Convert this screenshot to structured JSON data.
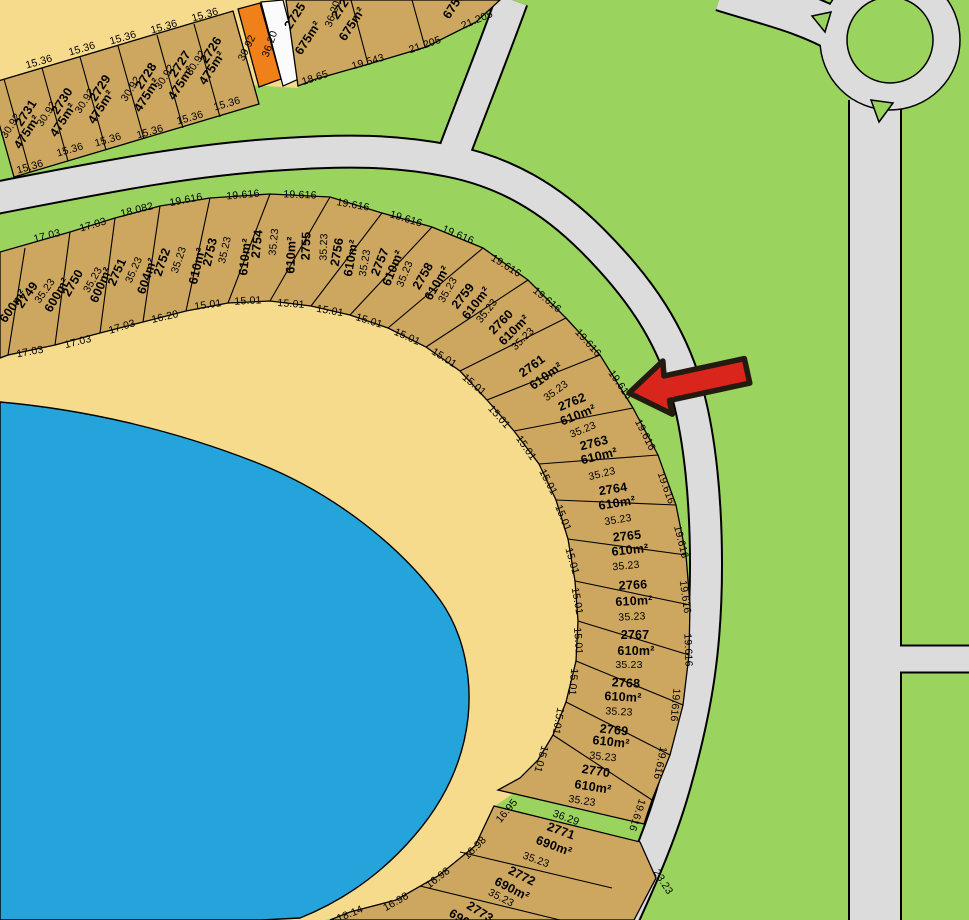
{
  "map_title": "Cadastral subdivision plan with lake, crescent road and roundabout",
  "colors": {
    "green": "#9ad45f",
    "road": "#dcdcdc",
    "sand": "#f7db8d",
    "lot": "#cda75f",
    "orange": "#f08019",
    "lake": "#24a4da",
    "path": "#fbfbfb",
    "line": "#000000",
    "arrow": "#da251c",
    "arrow_outline": "#231a10"
  },
  "marker": {
    "name": "red-arrow",
    "points_at_lot": "2762"
  },
  "lots_summary": {
    "top_row": [
      {
        "number": "2731",
        "area": "475m²"
      },
      {
        "number": "2730",
        "area": "475m²"
      },
      {
        "number": "2729",
        "area": "475m²"
      },
      {
        "number": "2728",
        "area": "475m²"
      },
      {
        "number": "2727",
        "area": "475m²"
      },
      {
        "number": "2726",
        "area": "475m²"
      },
      {
        "number": "2725",
        "area": "675m²"
      },
      {
        "number": "2724",
        "area": "675m²"
      }
    ],
    "crescent": [
      {
        "number": "2749",
        "area": "600m²"
      },
      {
        "number": "2750",
        "area": "600m²"
      },
      {
        "number": "2751",
        "area": "600m²"
      },
      {
        "number": "2752",
        "area": "604m²"
      },
      {
        "number": "2753",
        "area": "610m²"
      },
      {
        "number": "2754",
        "area": "610m²"
      },
      {
        "number": "2755",
        "area": "610m²"
      },
      {
        "number": "2756",
        "area": "610m²"
      },
      {
        "number": "2757",
        "area": "610m²"
      },
      {
        "number": "2758",
        "area": "610m²"
      },
      {
        "number": "2759",
        "area": "610m²"
      },
      {
        "number": "2760",
        "area": "610m²"
      },
      {
        "number": "2761",
        "area": "610m²"
      },
      {
        "number": "2762",
        "area": "610m²"
      },
      {
        "number": "2763",
        "area": "610m²"
      },
      {
        "number": "2764",
        "area": "610m²"
      },
      {
        "number": "2765",
        "area": "610m²"
      },
      {
        "number": "2766",
        "area": "610m²"
      },
      {
        "number": "2767",
        "area": "610m²"
      },
      {
        "number": "2768",
        "area": "610m²"
      },
      {
        "number": "2769",
        "area": "610m²"
      },
      {
        "number": "2770",
        "area": "610m²"
      },
      {
        "number": "2771",
        "area": "690m²"
      },
      {
        "number": "2772",
        "area": "690m²"
      },
      {
        "number": "2773",
        "area": "690m²"
      }
    ]
  },
  "labels": [
    {
      "t": "15.36",
      "x": 39,
      "y": 62,
      "r": -16,
      "d": 1
    },
    {
      "t": "15.36",
      "x": 82,
      "y": 49,
      "r": -16,
      "d": 1
    },
    {
      "t": "15.36",
      "x": 123,
      "y": 38,
      "r": -16,
      "d": 1
    },
    {
      "t": "15.36",
      "x": 164,
      "y": 27,
      "r": -16,
      "d": 1
    },
    {
      "t": "15.36",
      "x": 205,
      "y": 15,
      "r": -16,
      "d": 1
    },
    {
      "t": "15.36",
      "x": 30,
      "y": 167,
      "r": -16,
      "d": 1
    },
    {
      "t": "15.36",
      "x": 70,
      "y": 150,
      "r": -16,
      "d": 1
    },
    {
      "t": "15.36",
      "x": 108,
      "y": 140,
      "r": -16,
      "d": 1
    },
    {
      "t": "15.36",
      "x": 150,
      "y": 132,
      "r": -16,
      "d": 1
    },
    {
      "t": "15.36",
      "x": 190,
      "y": 118,
      "r": -16,
      "d": 1
    },
    {
      "t": "15.36",
      "x": 227,
      "y": 104,
      "r": -16,
      "d": 1
    },
    {
      "t": "2731",
      "x": 26,
      "y": 113,
      "r": -57
    },
    {
      "t": "30.92",
      "x": 11,
      "y": 126,
      "r": -57,
      "d": 1
    },
    {
      "t": "475m²",
      "x": 27,
      "y": 132,
      "r": -57
    },
    {
      "t": "2730",
      "x": 62,
      "y": 101,
      "r": -57
    },
    {
      "t": "30.92",
      "x": 47,
      "y": 114,
      "r": -57,
      "d": 1
    },
    {
      "t": "475m²",
      "x": 63,
      "y": 120,
      "r": -57
    },
    {
      "t": "2729",
      "x": 100,
      "y": 88,
      "r": -57
    },
    {
      "t": "30.92",
      "x": 85,
      "y": 101,
      "r": -57,
      "d": 1
    },
    {
      "t": "475m²",
      "x": 101,
      "y": 107,
      "r": -57
    },
    {
      "t": "2728",
      "x": 146,
      "y": 76,
      "r": -57
    },
    {
      "t": "30.92",
      "x": 131,
      "y": 89,
      "r": -57,
      "d": 1
    },
    {
      "t": "475m²",
      "x": 147,
      "y": 95,
      "r": -57
    },
    {
      "t": "2727",
      "x": 180,
      "y": 64,
      "r": -57
    },
    {
      "t": "30.92",
      "x": 165,
      "y": 77,
      "r": -57,
      "d": 1
    },
    {
      "t": "475m²",
      "x": 181,
      "y": 83,
      "r": -57
    },
    {
      "t": "2726",
      "x": 211,
      "y": 50,
      "r": -57
    },
    {
      "t": "30.92",
      "x": 196,
      "y": 63,
      "r": -57,
      "d": 1
    },
    {
      "t": "475m²",
      "x": 212,
      "y": 68,
      "r": -57
    },
    {
      "t": "39.92",
      "x": 247,
      "y": 48,
      "r": -64,
      "d": 1
    },
    {
      "t": "36.20",
      "x": 270,
      "y": 44,
      "r": -70,
      "d": 1
    },
    {
      "t": "2725",
      "x": 295,
      "y": 16,
      "r": -57
    },
    {
      "t": "675m²",
      "x": 308,
      "y": 38,
      "r": -57
    },
    {
      "t": "36.20",
      "x": 333,
      "y": 14,
      "r": -70,
      "d": 1
    },
    {
      "t": "2724",
      "x": 342,
      "y": 6,
      "r": -57
    },
    {
      "t": "675m²",
      "x": 352,
      "y": 24,
      "r": -57
    },
    {
      "t": "675m²",
      "x": 456,
      "y": 2,
      "r": -57
    },
    {
      "t": "18.65",
      "x": 315,
      "y": 78,
      "r": -18,
      "d": 1
    },
    {
      "t": "19.543",
      "x": 368,
      "y": 62,
      "r": -16,
      "d": 1
    },
    {
      "t": "21.205",
      "x": 425,
      "y": 45,
      "r": -19,
      "d": 1
    },
    {
      "t": "21.205",
      "x": 477,
      "y": 20,
      "r": -23,
      "d": 1
    },
    {
      "t": "17.03",
      "x": 47,
      "y": 236,
      "r": -14,
      "d": 1
    },
    {
      "t": "17.03",
      "x": 93,
      "y": 225,
      "r": -16,
      "d": 1
    },
    {
      "t": "18.082",
      "x": 137,
      "y": 210,
      "r": -14,
      "d": 1
    },
    {
      "t": "19.616",
      "x": 186,
      "y": 200,
      "r": -11,
      "d": 1
    },
    {
      "t": "19.616",
      "x": 243,
      "y": 195,
      "r": -5,
      "d": 1
    },
    {
      "t": "19.616",
      "x": 300,
      "y": 195,
      "r": 2,
      "d": 1
    },
    {
      "t": "19.616",
      "x": 353,
      "y": 205,
      "r": 10,
      "d": 1
    },
    {
      "t": "19.616",
      "x": 406,
      "y": 219,
      "r": 17,
      "d": 1
    },
    {
      "t": "19.616",
      "x": 458,
      "y": 235,
      "r": 23,
      "d": 1
    },
    {
      "t": "19.616",
      "x": 506,
      "y": 266,
      "r": 32,
      "d": 1
    },
    {
      "t": "19.616",
      "x": 547,
      "y": 300,
      "r": 40,
      "d": 1
    },
    {
      "t": "19.616",
      "x": 588,
      "y": 343,
      "r": 48,
      "d": 1
    },
    {
      "t": "19.616",
      "x": 620,
      "y": 385,
      "r": 55,
      "d": 1
    },
    {
      "t": "19.616",
      "x": 645,
      "y": 435,
      "r": 63,
      "d": 1
    },
    {
      "t": "19.616",
      "x": 666,
      "y": 488,
      "r": 70,
      "d": 1
    },
    {
      "t": "19.616",
      "x": 681,
      "y": 542,
      "r": 76,
      "d": 1
    },
    {
      "t": "19.616",
      "x": 685,
      "y": 597,
      "r": 82,
      "d": 1
    },
    {
      "t": "19.616",
      "x": 688,
      "y": 650,
      "r": 88,
      "d": 1
    },
    {
      "t": "19.616",
      "x": 675,
      "y": 705,
      "r": 95,
      "d": 1
    },
    {
      "t": "19.616",
      "x": 660,
      "y": 763,
      "r": 101,
      "d": 1
    },
    {
      "t": "19.616",
      "x": 637,
      "y": 815,
      "r": 108,
      "d": 1
    },
    {
      "t": "17.03",
      "x": 30,
      "y": 352,
      "r": -10,
      "d": 1
    },
    {
      "t": "17.03",
      "x": 78,
      "y": 342,
      "r": -14,
      "d": 1
    },
    {
      "t": "17.03",
      "x": 122,
      "y": 327,
      "r": -17,
      "d": 1
    },
    {
      "t": "16.20",
      "x": 165,
      "y": 317,
      "r": -13,
      "d": 1
    },
    {
      "t": "15.01",
      "x": 208,
      "y": 305,
      "r": -8,
      "d": 1
    },
    {
      "t": "15.01",
      "x": 248,
      "y": 301,
      "r": -3,
      "d": 1
    },
    {
      "t": "15.01",
      "x": 291,
      "y": 304,
      "r": 4,
      "d": 1
    },
    {
      "t": "15.01",
      "x": 330,
      "y": 311,
      "r": 10,
      "d": 1
    },
    {
      "t": "15.01",
      "x": 369,
      "y": 321,
      "r": 17,
      "d": 1
    },
    {
      "t": "15.01",
      "x": 407,
      "y": 337,
      "r": 24,
      "d": 1
    },
    {
      "t": "15.01",
      "x": 444,
      "y": 358,
      "r": 32,
      "d": 1
    },
    {
      "t": "15.01",
      "x": 474,
      "y": 385,
      "r": 40,
      "d": 1
    },
    {
      "t": "15.01",
      "x": 499,
      "y": 417,
      "r": 48,
      "d": 1
    },
    {
      "t": "15.01",
      "x": 526,
      "y": 448,
      "r": 55,
      "d": 1
    },
    {
      "t": "15.01",
      "x": 548,
      "y": 482,
      "r": 62,
      "d": 1
    },
    {
      "t": "15.01",
      "x": 563,
      "y": 518,
      "r": 68,
      "d": 1
    },
    {
      "t": "15.01",
      "x": 572,
      "y": 561,
      "r": 74,
      "d": 1
    },
    {
      "t": "15.01",
      "x": 577,
      "y": 601,
      "r": 80,
      "d": 1
    },
    {
      "t": "15.01",
      "x": 578,
      "y": 641,
      "r": 86,
      "d": 1
    },
    {
      "t": "15.01",
      "x": 573,
      "y": 682,
      "r": 95,
      "d": 1
    },
    {
      "t": "15.01",
      "x": 558,
      "y": 721,
      "r": 100,
      "d": 1
    },
    {
      "t": "15.01",
      "x": 541,
      "y": 759,
      "r": 106,
      "d": 1
    },
    {
      "t": "16.95",
      "x": 507,
      "y": 811,
      "r": -50,
      "d": 1
    },
    {
      "t": "16.98",
      "x": 475,
      "y": 848,
      "r": -45,
      "d": 1
    },
    {
      "t": "16.98",
      "x": 438,
      "y": 878,
      "r": -38,
      "d": 1
    },
    {
      "t": "16.98",
      "x": 396,
      "y": 902,
      "r": -30,
      "d": 1
    },
    {
      "t": "18.14",
      "x": 350,
      "y": 914,
      "r": -22,
      "d": 1
    },
    {
      "t": "2749",
      "x": 27,
      "y": 295,
      "r": -55
    },
    {
      "t": "600m²",
      "x": 13,
      "y": 306,
      "r": -55
    },
    {
      "t": "35.23",
      "x": 45,
      "y": 291,
      "r": -55,
      "d": 1
    },
    {
      "t": "2750",
      "x": 73,
      "y": 283,
      "r": -60
    },
    {
      "t": "600m²",
      "x": 57,
      "y": 295,
      "r": -60
    },
    {
      "t": "35.23",
      "x": 93,
      "y": 280,
      "r": -60,
      "d": 1
    },
    {
      "t": "2751",
      "x": 117,
      "y": 272,
      "r": -66
    },
    {
      "t": "600m²",
      "x": 101,
      "y": 285,
      "r": -66
    },
    {
      "t": "35.23",
      "x": 134,
      "y": 270,
      "r": -66,
      "d": 1
    },
    {
      "t": "2752",
      "x": 162,
      "y": 262,
      "r": -71
    },
    {
      "t": "604m²",
      "x": 147,
      "y": 276,
      "r": -71
    },
    {
      "t": "35.23",
      "x": 179,
      "y": 260,
      "r": -71,
      "d": 1
    },
    {
      "t": "2753",
      "x": 210,
      "y": 252,
      "r": -77
    },
    {
      "t": "610m²",
      "x": 197,
      "y": 266,
      "r": -77
    },
    {
      "t": "35.23",
      "x": 225,
      "y": 250,
      "r": -77,
      "d": 1
    },
    {
      "t": "2754",
      "x": 257,
      "y": 244,
      "r": -84
    },
    {
      "t": "610m²",
      "x": 245,
      "y": 257,
      "r": -84
    },
    {
      "t": "35.23",
      "x": 274,
      "y": 242,
      "r": -84,
      "d": 1
    },
    {
      "t": "2755",
      "x": 306,
      "y": 246,
      "r": -88
    },
    {
      "t": "610m²",
      "x": 291,
      "y": 255,
      "r": -88
    },
    {
      "t": "35.23",
      "x": 324,
      "y": 247,
      "r": -88,
      "d": 1
    },
    {
      "t": "2756",
      "x": 337,
      "y": 252,
      "r": -80
    },
    {
      "t": "610m²",
      "x": 351,
      "y": 258,
      "r": -80
    },
    {
      "t": "35.23",
      "x": 365,
      "y": 263,
      "r": -80,
      "d": 1
    },
    {
      "t": "2757",
      "x": 380,
      "y": 262,
      "r": -68
    },
    {
      "t": "610m²",
      "x": 393,
      "y": 268,
      "r": -68
    },
    {
      "t": "35.23",
      "x": 405,
      "y": 274,
      "r": -68,
      "d": 1
    },
    {
      "t": "2758",
      "x": 423,
      "y": 276,
      "r": -60
    },
    {
      "t": "610m²",
      "x": 437,
      "y": 283,
      "r": -60
    },
    {
      "t": "35.23",
      "x": 448,
      "y": 290,
      "r": -60,
      "d": 1
    },
    {
      "t": "2759",
      "x": 463,
      "y": 296,
      "r": -52
    },
    {
      "t": "610m²",
      "x": 476,
      "y": 303,
      "r": -52
    },
    {
      "t": "35.23",
      "x": 487,
      "y": 311,
      "r": -52,
      "d": 1
    },
    {
      "t": "2760",
      "x": 501,
      "y": 322,
      "r": -45
    },
    {
      "t": "610m²",
      "x": 514,
      "y": 330,
      "r": -45
    },
    {
      "t": "35.23",
      "x": 523,
      "y": 339,
      "r": -45,
      "d": 1
    },
    {
      "t": "2761",
      "x": 532,
      "y": 366,
      "r": -36
    },
    {
      "t": "610m²",
      "x": 546,
      "y": 376,
      "r": -36
    },
    {
      "t": "35.23",
      "x": 556,
      "y": 391,
      "r": -36,
      "d": 1
    },
    {
      "t": "2762",
      "x": 572,
      "y": 402,
      "r": -22
    },
    {
      "t": "610m²",
      "x": 578,
      "y": 415,
      "r": -22
    },
    {
      "t": "35.23",
      "x": 583,
      "y": 430,
      "r": -22,
      "d": 1
    },
    {
      "t": "2763",
      "x": 594,
      "y": 443,
      "r": -14
    },
    {
      "t": "610m²",
      "x": 599,
      "y": 456,
      "r": -14
    },
    {
      "t": "35.23",
      "x": 602,
      "y": 474,
      "r": -14,
      "d": 1
    },
    {
      "t": "2764",
      "x": 613,
      "y": 489,
      "r": -9
    },
    {
      "t": "610m²",
      "x": 617,
      "y": 503,
      "r": -9
    },
    {
      "t": "35.23",
      "x": 618,
      "y": 520,
      "r": -9,
      "d": 1
    },
    {
      "t": "2765",
      "x": 627,
      "y": 536,
      "r": -6
    },
    {
      "t": "610m²",
      "x": 630,
      "y": 550,
      "r": -6
    },
    {
      "t": "35.23",
      "x": 626,
      "y": 566,
      "r": -6,
      "d": 1
    },
    {
      "t": "2766",
      "x": 633,
      "y": 585,
      "r": -3
    },
    {
      "t": "610m²",
      "x": 634,
      "y": 601,
      "r": -3
    },
    {
      "t": "35.23",
      "x": 632,
      "y": 617,
      "r": -3,
      "d": 1
    },
    {
      "t": "2767",
      "x": 635,
      "y": 635,
      "r": 0
    },
    {
      "t": "610m²",
      "x": 636,
      "y": 651,
      "r": 0
    },
    {
      "t": "35.23",
      "x": 629,
      "y": 665,
      "r": 0,
      "d": 1
    },
    {
      "t": "2768",
      "x": 626,
      "y": 683,
      "r": 3
    },
    {
      "t": "610m²",
      "x": 623,
      "y": 697,
      "r": 3
    },
    {
      "t": "35.23",
      "x": 619,
      "y": 712,
      "r": 3,
      "d": 1
    },
    {
      "t": "2769",
      "x": 614,
      "y": 730,
      "r": 6
    },
    {
      "t": "610m²",
      "x": 611,
      "y": 742,
      "r": 6
    },
    {
      "t": "35.23",
      "x": 603,
      "y": 757,
      "r": 6,
      "d": 1
    },
    {
      "t": "2770",
      "x": 596,
      "y": 771,
      "r": 9
    },
    {
      "t": "610m²",
      "x": 593,
      "y": 787,
      "r": 9
    },
    {
      "t": "35.23",
      "x": 582,
      "y": 801,
      "r": 9,
      "d": 1
    },
    {
      "t": "36.29",
      "x": 566,
      "y": 818,
      "r": 20,
      "d": 1
    },
    {
      "t": "2771",
      "x": 561,
      "y": 831,
      "r": 20
    },
    {
      "t": "690m²",
      "x": 554,
      "y": 846,
      "r": 20
    },
    {
      "t": "35.23",
      "x": 536,
      "y": 860,
      "r": 20,
      "d": 1
    },
    {
      "t": "2772",
      "x": 522,
      "y": 876,
      "r": 27
    },
    {
      "t": "690m²",
      "x": 512,
      "y": 889,
      "r": 27
    },
    {
      "t": "35.23",
      "x": 501,
      "y": 898,
      "r": 27,
      "d": 1
    },
    {
      "t": "23.23",
      "x": 663,
      "y": 882,
      "r": 58,
      "d": 1
    },
    {
      "t": "2773",
      "x": 480,
      "y": 912,
      "r": 32
    },
    {
      "t": "690m²",
      "x": 466,
      "y": 922,
      "r": 32
    }
  ]
}
